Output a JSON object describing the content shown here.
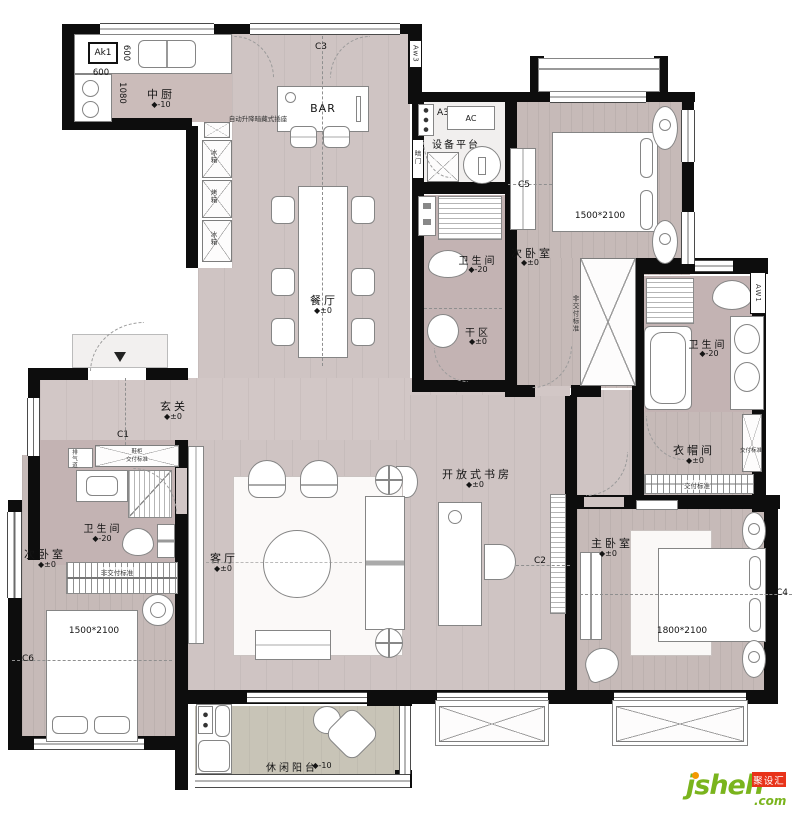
{
  "rooms": {
    "kitchen": {
      "name": "中厨",
      "elev": "◆-10"
    },
    "dining": {
      "name": "餐厅",
      "elev": "◆±0"
    },
    "bar": {
      "name": "BAR"
    },
    "equipment": {
      "name": "设备平台"
    },
    "ac_unit": {
      "name": "AC"
    },
    "bedroom_tr": {
      "name": "次卧室",
      "elev": "◆±0"
    },
    "bath_mid": {
      "name": "卫生间",
      "elev": "◆-20"
    },
    "dry_area": {
      "name": "干区",
      "elev": "◆±0"
    },
    "entry": {
      "name": "玄关",
      "elev": "◆±0"
    },
    "bath_left": {
      "name": "卫生间",
      "elev": "◆-20"
    },
    "living": {
      "name": "客厅",
      "elev": "◆±0"
    },
    "study": {
      "name": "开放式书房",
      "elev": "◆±0"
    },
    "bath_master": {
      "name": "卫生间",
      "elev": "◆-20"
    },
    "closet": {
      "name": "衣帽间",
      "elev": "◆±0"
    },
    "master": {
      "name": "主卧室",
      "elev": "◆±0"
    },
    "bedroom_bl": {
      "name": "次卧室",
      "elev": "◆±0"
    },
    "balcony": {
      "name": "休闲阳台",
      "elev": "◆-10"
    }
  },
  "beds": {
    "top_right": "1500*2100",
    "master": "1800*2100",
    "bottom_left": "1500*2100"
  },
  "dims": {
    "d600v": "600",
    "d600h": "600",
    "d1080": "1080"
  },
  "marks": {
    "ak1": "Ak1",
    "aw3": "Aw3",
    "a3": "A3",
    "aw1": "AW1",
    "c1": "C1",
    "c2": "C2",
    "c3": "C3",
    "c4": "C4",
    "c5": "C5",
    "c6": "C6"
  },
  "notes": {
    "socket": "自动升降暗藏式插座",
    "hidden_door": "暗门",
    "vent": "排气道",
    "shoe_cabinet": "鞋柜",
    "delivery": "交付标准",
    "non_delivery": "非交付标准",
    "fridge": "冰箱",
    "oven": "烤箱"
  },
  "logo": {
    "brand": "jsheh",
    "tld": ".com",
    "badge": "聚设汇"
  },
  "colors": {
    "wall": "#0d0d0d",
    "floor_main": "#cfc4c3",
    "floor_bath": "#c3b3b3",
    "balcony": "#c8c4b7",
    "logo_green": "#7ab41d",
    "logo_red": "#e8331a",
    "logo_orange": "#f39800"
  }
}
